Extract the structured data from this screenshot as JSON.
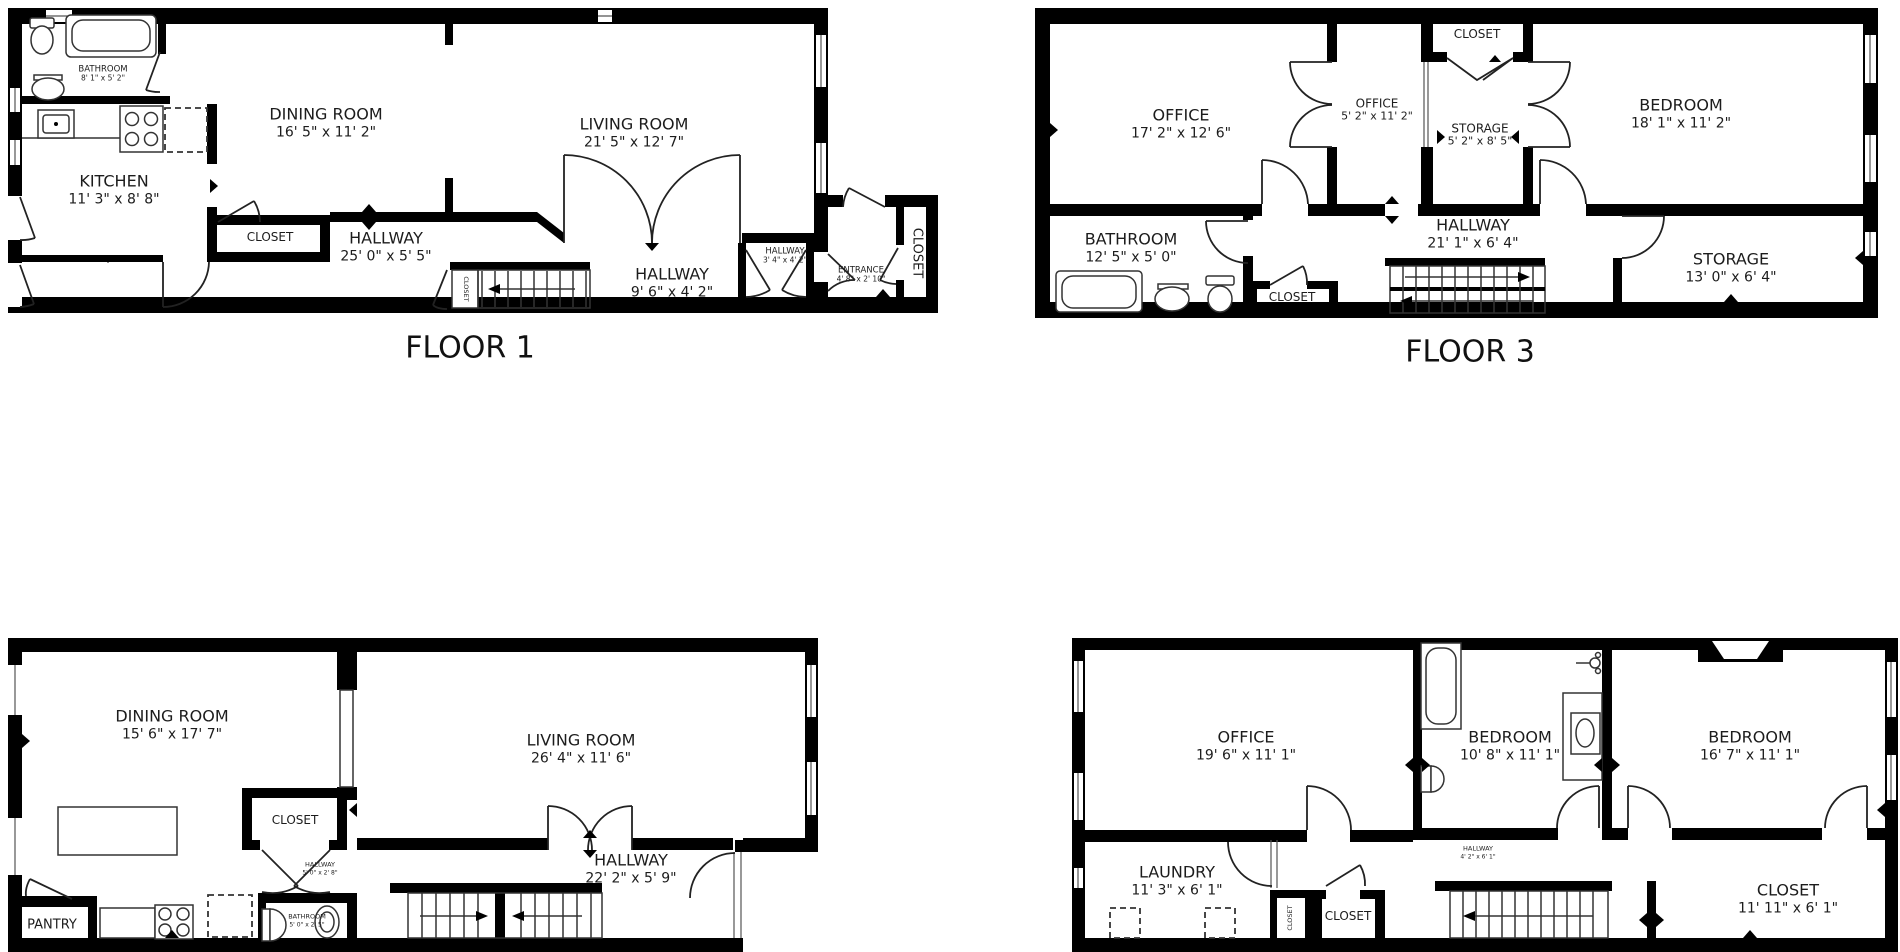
{
  "colors": {
    "background": "#ffffff",
    "walls": "#000000",
    "lines": "#333333",
    "text": "#1c1c1c"
  },
  "floors": [
    {
      "label": "FLOOR 1",
      "rooms": {
        "bathroom": {
          "name": "BATHROOM",
          "dims": "8' 1\" x 5' 2\""
        },
        "kitchen": {
          "name": "KITCHEN",
          "dims": "11' 3\" x 8' 8\""
        },
        "dining_room": {
          "name": "DINING ROOM",
          "dims": "16' 5\" x 11' 2\""
        },
        "living_room": {
          "name": "LIVING ROOM",
          "dims": "21' 5\" x 12' 7\""
        },
        "closet": {
          "name": "CLOSET"
        },
        "hallway": {
          "name": "HALLWAY",
          "dims": "25' 0\" x 5' 5\""
        },
        "stair_closet": {
          "name": "CLOSET"
        },
        "hallway_2": {
          "name": "HALLWAY",
          "dims": "9' 6\" x 4' 2\""
        },
        "hallway_3": {
          "name": "HALLWAY",
          "dims": "3' 4\" x 4' 2\""
        },
        "entrance": {
          "name": "ENTRANCE",
          "dims": "4' 8\" x 2' 10\""
        },
        "entry_closet": {
          "name": "CLOSET"
        }
      }
    },
    {
      "label": "FLOOR 3",
      "rooms": {
        "office": {
          "name": "OFFICE",
          "dims": "17' 2\" x 12' 6\""
        },
        "office_2": {
          "name": "OFFICE",
          "dims": "5' 2\" x 11' 2\""
        },
        "closet": {
          "name": "CLOSET"
        },
        "storage": {
          "name": "STORAGE",
          "dims": "5' 2\" x 8' 5\""
        },
        "bedroom": {
          "name": "BEDROOM",
          "dims": "18' 1\" x 11' 2\""
        },
        "bathroom": {
          "name": "BATHROOM",
          "dims": "12' 5\" x 5' 0\""
        },
        "hall_closet": {
          "name": "CLOSET"
        },
        "hallway": {
          "name": "HALLWAY",
          "dims": "21' 1\" x 6' 4\""
        },
        "storage_2": {
          "name": "STORAGE",
          "dims": "13' 0\" x 6' 4\""
        }
      }
    },
    {
      "rooms": {
        "dining_room": {
          "name": "DINING ROOM",
          "dims": "15' 6\" x 17' 7\""
        },
        "closet": {
          "name": "CLOSET"
        },
        "living_room": {
          "name": "LIVING ROOM",
          "dims": "26' 4\" x 11' 6\""
        },
        "hallway_small": {
          "name": "HALLWAY",
          "dims": "5' 0\" x 2' 8\""
        },
        "pantry": {
          "name": "PANTRY"
        },
        "bathroom": {
          "name": "BATHROOM",
          "dims": "5' 0\" x 2' 5\""
        },
        "hallway": {
          "name": "HALLWAY",
          "dims": "22' 2\" x 5' 9\""
        }
      }
    },
    {
      "rooms": {
        "office": {
          "name": "OFFICE",
          "dims": "19' 6\" x 11' 1\""
        },
        "laundry": {
          "name": "LAUNDRY",
          "dims": "11' 3\" x 6' 1\""
        },
        "bedroom": {
          "name": "BEDROOM",
          "dims": "10' 8\" x 11' 1\""
        },
        "bedroom_2": {
          "name": "BEDROOM",
          "dims": "16' 7\" x 11' 1\""
        },
        "hallway": {
          "name": "HALLWAY",
          "dims": "4' 2\" x 6' 1\""
        },
        "closet_small": {
          "name": "CLOSET"
        },
        "closet_2": {
          "name": "CLOSET"
        },
        "closet": {
          "name": "CLOSET",
          "dims": "11' 11\" x 6' 1\""
        }
      }
    }
  ]
}
